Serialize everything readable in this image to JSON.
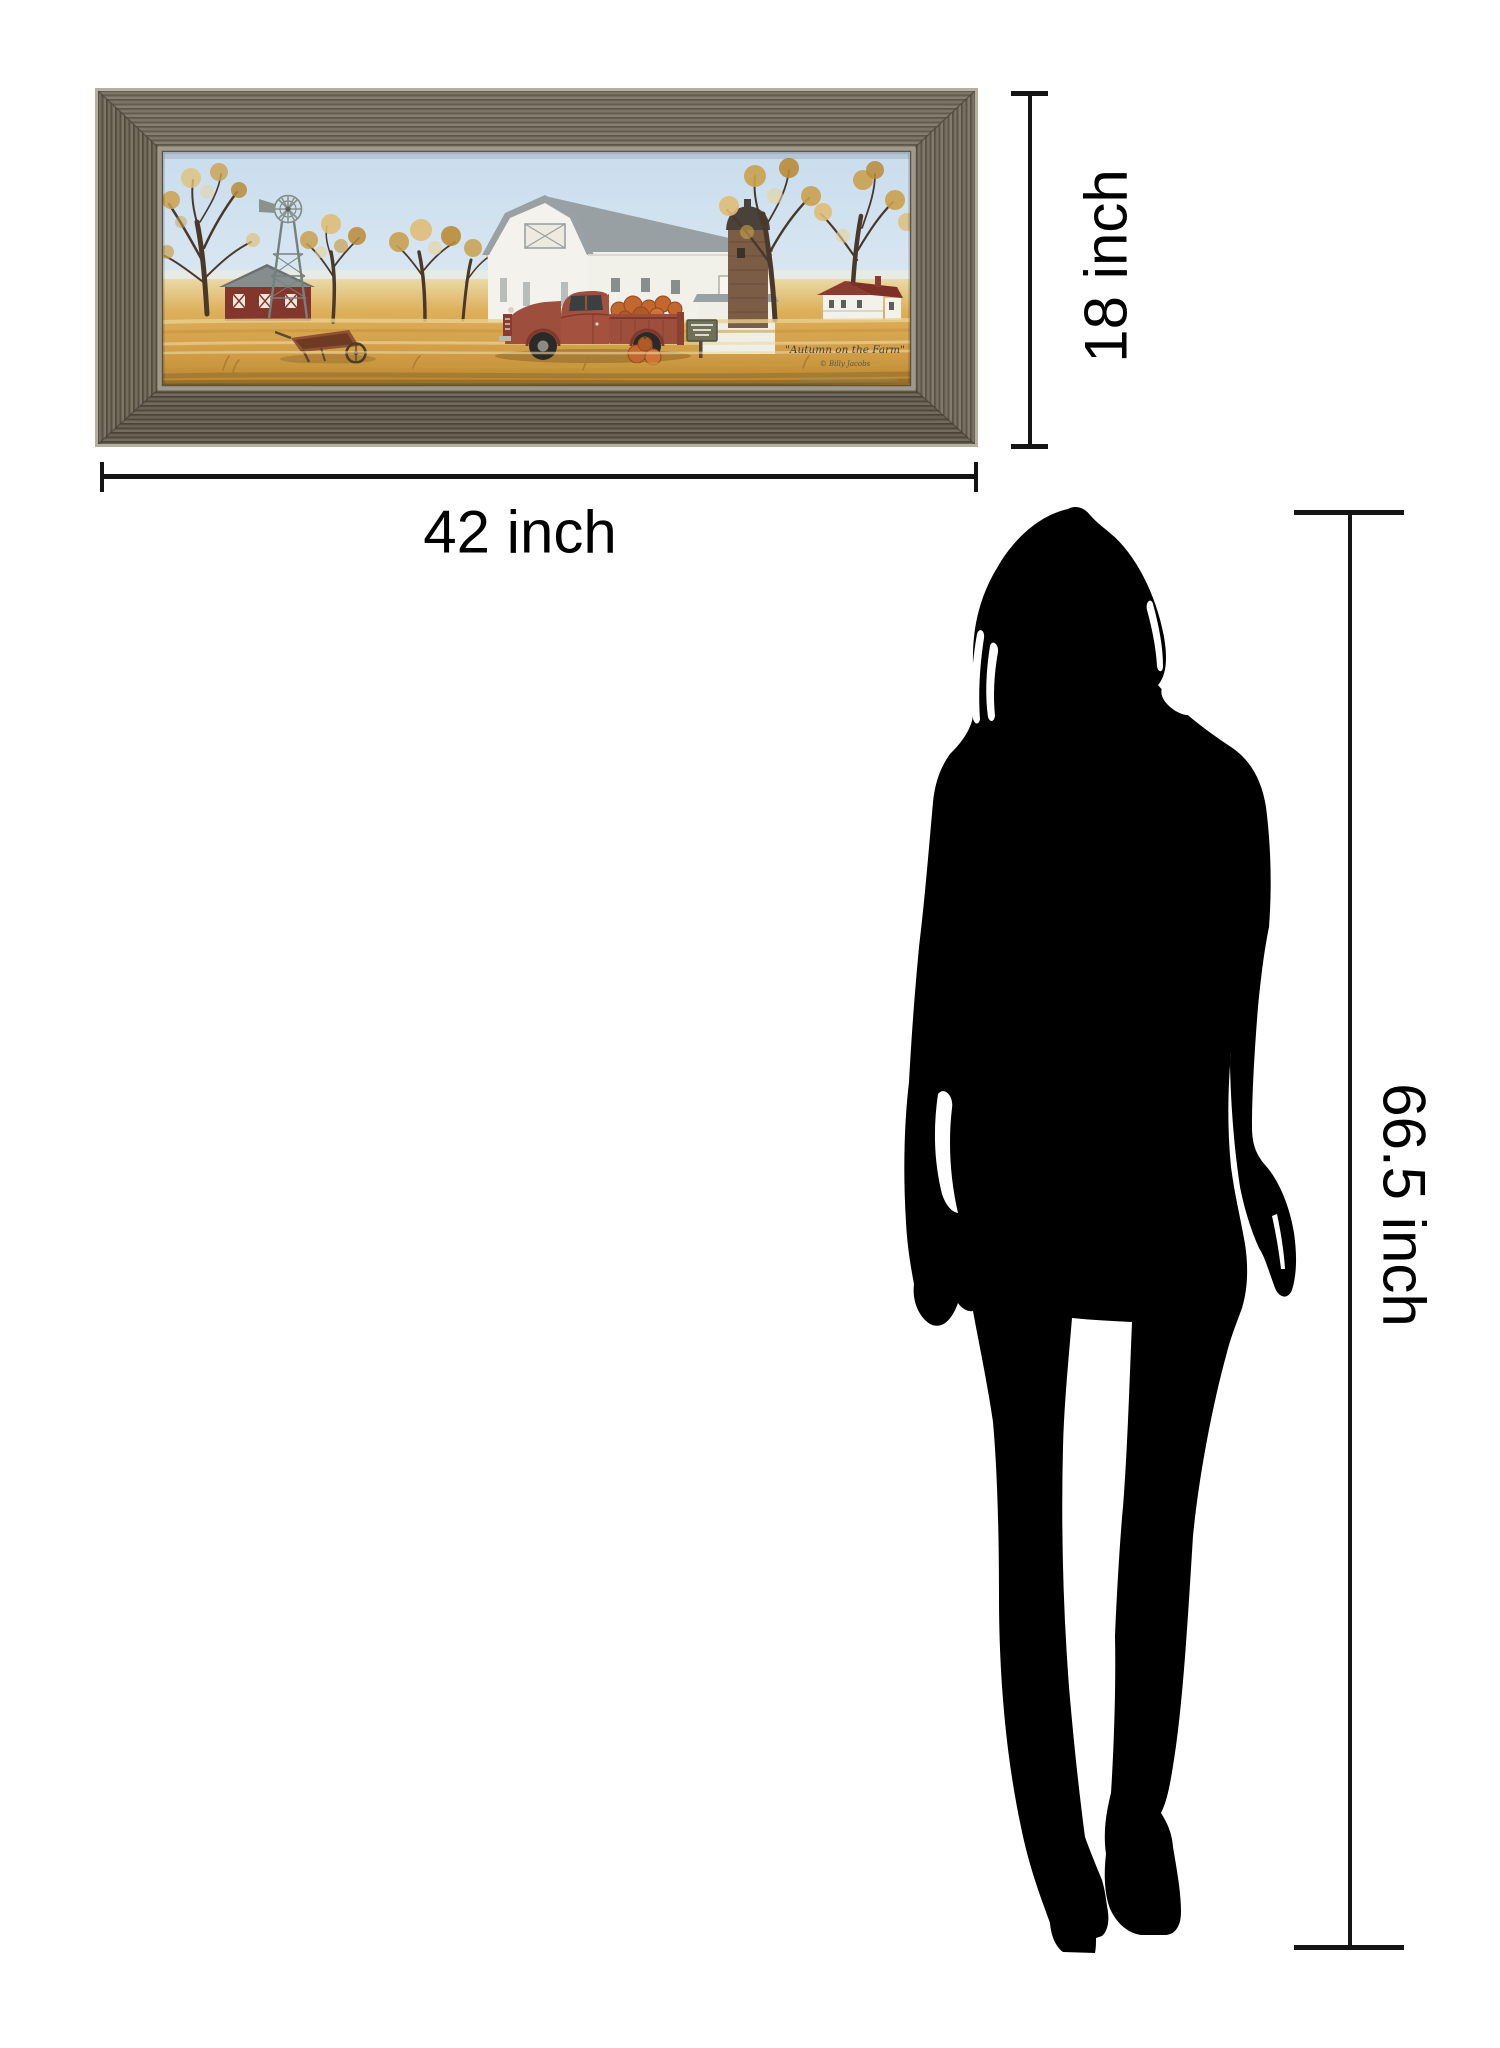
{
  "diagram": {
    "kind": "product-size-comparison",
    "background": "#ffffff",
    "line_color": "#141414"
  },
  "dimensions": {
    "width": {
      "label": "42 inch"
    },
    "height": {
      "label": "18 inch"
    },
    "person_height": {
      "label": "66.5 inch"
    }
  },
  "artwork": {
    "signature": "\"Autumn on the Farm\"",
    "artist_credit": "© Billy Jacobs",
    "palette": {
      "frame_wood": "#665f50",
      "frame_edge_light": "#b6ae9e",
      "frame_lip": "#a09888",
      "sky_top": "#c9ddee",
      "sky_bottom": "#eef3f4",
      "field_gold": "#d8a84f",
      "barn_wall_white": "#f3f2ec",
      "barn_roof_gray": "#9aa1a4",
      "shed_red": "#83362b",
      "silo_brick": "#7b5c45",
      "truck_red": "#9d4e3c",
      "pumpkin_orange": "#c2672f",
      "sign_green": "#6e7158",
      "tree_branch": "#4a392b",
      "foliage_gold": "#caa14e"
    }
  },
  "figure": {
    "kind": "woman-silhouette",
    "color": "#000000"
  }
}
